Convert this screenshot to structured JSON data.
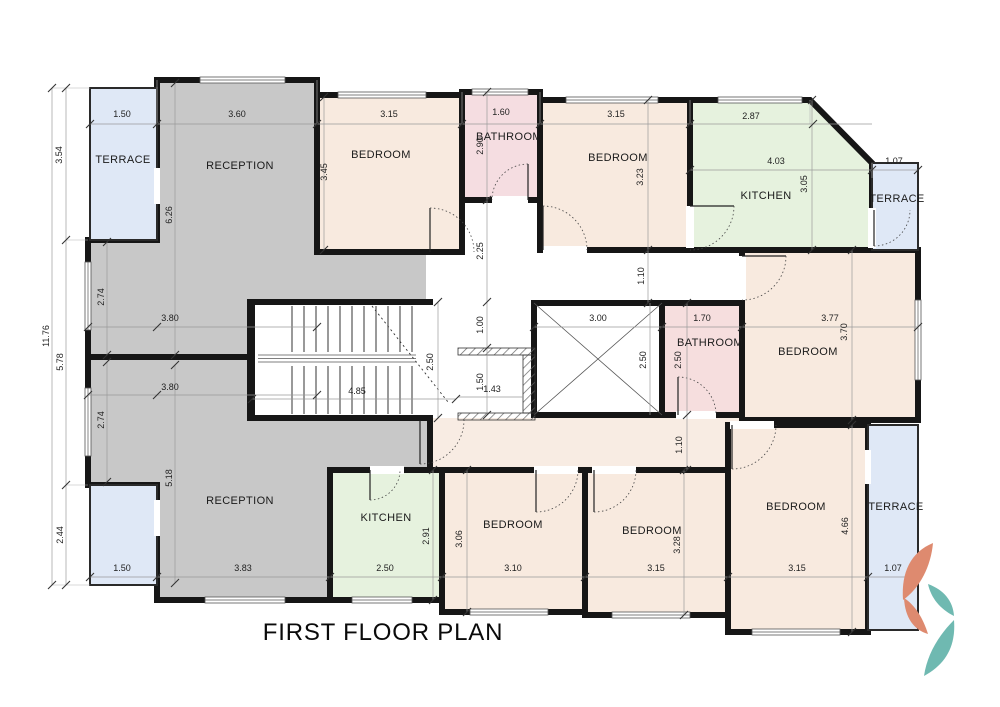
{
  "title": "FIRST FLOOR PLAN",
  "colors": {
    "wall": "#161616",
    "reception": "#c8c8c8",
    "bedroom": "#f8eadf",
    "corridor": "#f8ece3",
    "bathroom_top": "#f5dde1",
    "bathroom_mid": "#f6dede",
    "kitchen": "#e6f2de",
    "terrace": "#dfe8f6",
    "logo_coral": "#de8a6f",
    "logo_teal": "#6fb9b1"
  },
  "rooms": {
    "terrace_tl": "TERRACE",
    "reception_top": "RECEPTION",
    "bedroom_t1": "BEDROOM",
    "bathroom_t": "BATHROOM",
    "bedroom_t2": "BEDROOM",
    "kitchen_t": "KITCHEN",
    "terrace_tr": "TERRACE",
    "bathroom_m": "BATHROOM",
    "bedroom_r": "BEDROOM",
    "reception_b": "RECEPTION",
    "kitchen_b": "KITCHEN",
    "bedroom_b1": "BEDROOM",
    "bedroom_b2": "BEDROOM",
    "bedroom_b3": "BEDROOM",
    "terrace_br": "TERRACE"
  },
  "dims": {
    "d150_tl": "1.50",
    "d360": "3.60",
    "d315_t1": "3.15",
    "d160": "1.60",
    "d315_t2": "3.15",
    "d287": "2.87",
    "d403": "4.03",
    "d107_tr": "1.07",
    "d380_a": "3.80",
    "d380_b": "3.80",
    "d300": "3.00",
    "d170": "1.70",
    "d377": "3.77",
    "d485": "4.85",
    "d143": "1.43",
    "d150_bl": "1.50",
    "d383": "3.83",
    "d250_kb": "2.50",
    "d310": "3.10",
    "d315_b2": "3.15",
    "d315_b3": "3.15",
    "d107_br": "1.07",
    "v354": "3.54",
    "v1176": "11.76",
    "v578": "5.78",
    "v274_a": "2.74",
    "v274_b": "2.74",
    "v626": "6.26",
    "v518": "5.18",
    "v244": "2.44",
    "v345": "3.45",
    "v290": "2.90",
    "v323": "3.23",
    "v305": "3.05",
    "v225": "2.25",
    "v110_a": "1.10",
    "v250_st": "2.50",
    "v100": "1.00",
    "v150_c": "1.50",
    "v250_sh": "2.50",
    "v250_bm": "2.50",
    "v370": "3.70",
    "v110_b": "1.10",
    "v291": "2.91",
    "v306": "3.06",
    "v328": "3.28",
    "v466": "4.66"
  }
}
